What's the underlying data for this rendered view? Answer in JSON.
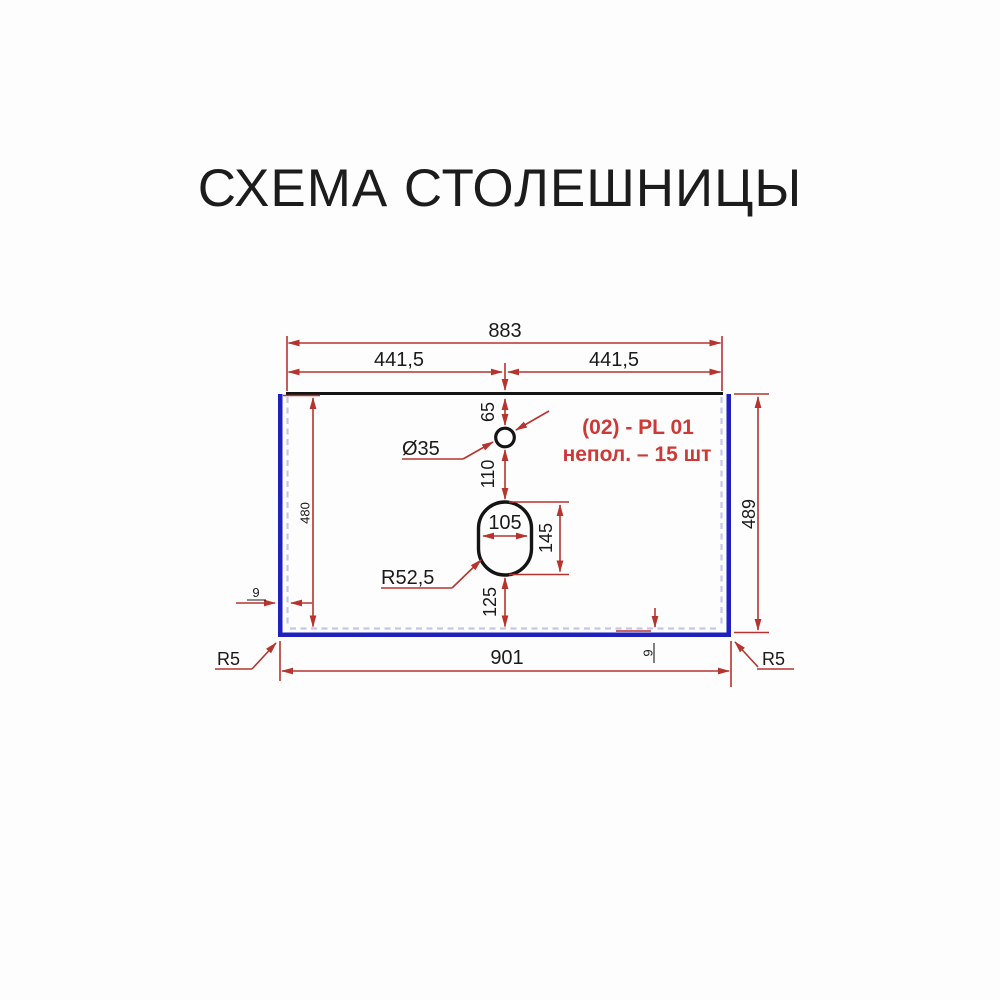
{
  "title": "СХЕМА СТОЛЕШНИЦЫ",
  "annotation": {
    "line1": "(02) - PL 01",
    "line2": "непол. – 15 шт"
  },
  "dimensions": {
    "top_width": "883",
    "half_width_left": "441,5",
    "half_width_right": "441,5",
    "faucet_offset": "65",
    "faucet_diameter": "Ø35",
    "faucet_to_sink": "110",
    "sink_width": "105",
    "sink_height": "145",
    "sink_to_front_edge": "125",
    "inner_depth": "480",
    "outer_depth": "489",
    "bottom_width": "901",
    "left_edge_thickness": "9",
    "bottom_edge_thickness": "9",
    "sink_radius": "R52,5",
    "corner_radius_left": "R5",
    "corner_radius_right": "R5"
  },
  "colors": {
    "dimension_red": "#b5342e",
    "annotation_red": "#cc3936",
    "edge_blue": "#2020bf",
    "outline_black": "#141414",
    "dashed_inner": "#c6c6ea",
    "background": "#fdfdfd"
  }
}
